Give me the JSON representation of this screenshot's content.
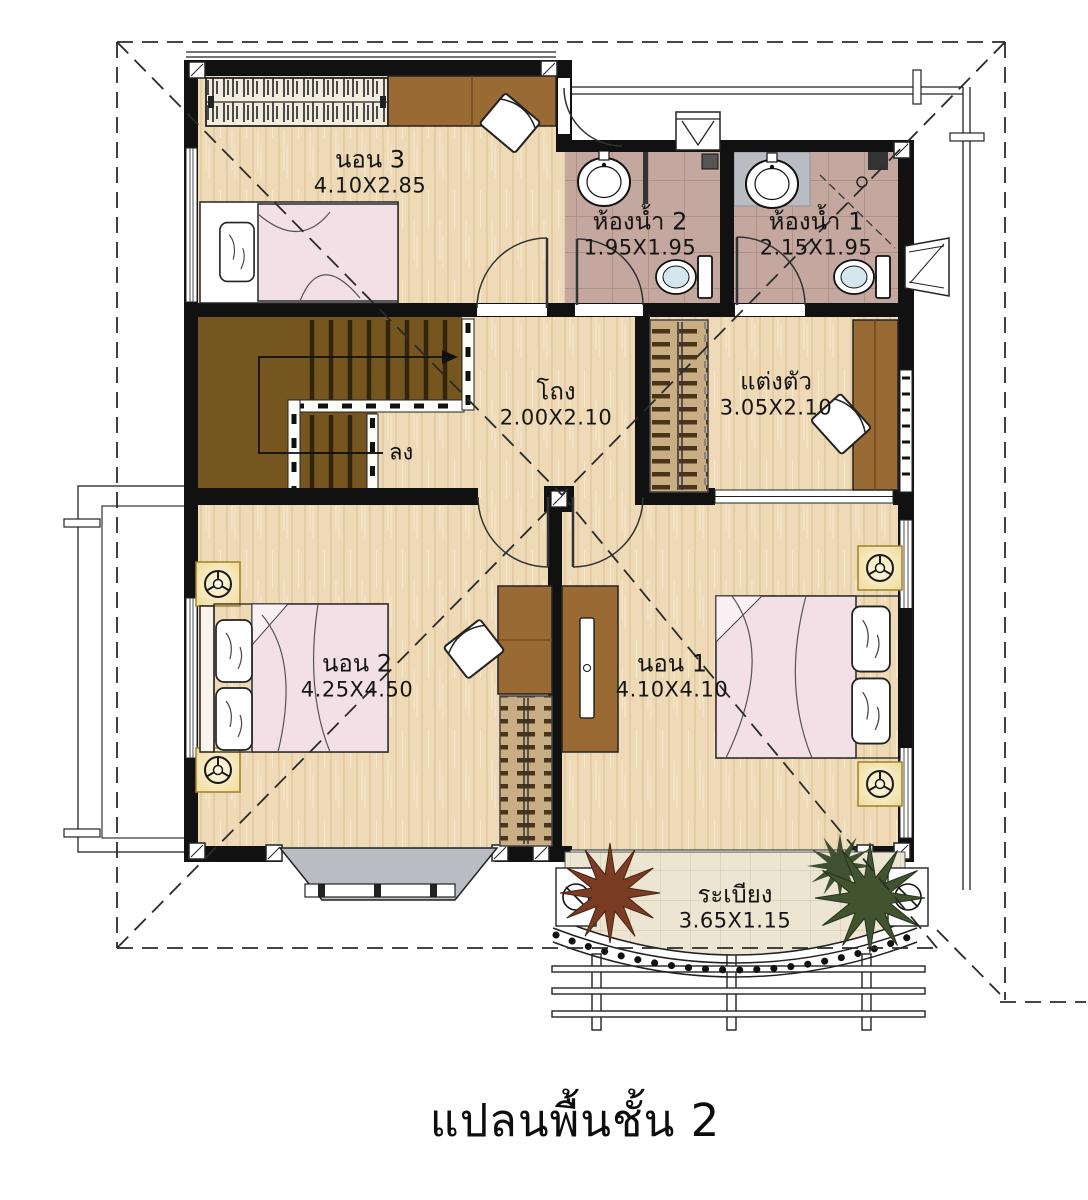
{
  "title": "แปลนพื้นชั้น 2",
  "rooms": [
    {
      "id": "bedroom-3",
      "name": "นอน 3",
      "size": "4.10X2.85"
    },
    {
      "id": "bathroom-2",
      "name": "ห้องน้ำ 2",
      "size": "1.95X1.95"
    },
    {
      "id": "bathroom-1",
      "name": "ห้องน้ำ 1",
      "size": "2.15X1.95"
    },
    {
      "id": "hall",
      "name": "โถง",
      "size": "2.00X2.10"
    },
    {
      "id": "dressing",
      "name": "แต่งตัว",
      "size": "3.05X2.10"
    },
    {
      "id": "bedroom-2",
      "name": "นอน 2",
      "size": "4.25X4.50"
    },
    {
      "id": "bedroom-1",
      "name": "นอน 1",
      "size": "4.10X4.10"
    },
    {
      "id": "balcony",
      "name": "ระเบียง",
      "size": "3.65X1.15"
    }
  ],
  "annotations": {
    "stairs_down": "ลง"
  },
  "colors": {
    "wall": "#111111",
    "wood_floor": "#eedab6",
    "stair_wood": "#75561f",
    "furniture_wood": "#9a6a34",
    "bath_tile": "#c4a8a0",
    "shower_gray": "#b9bdc3",
    "balcony_tile": "#ece5d1",
    "blanket_pink": "#f3e0e6",
    "lamp_glow": "#f7ecc4"
  }
}
